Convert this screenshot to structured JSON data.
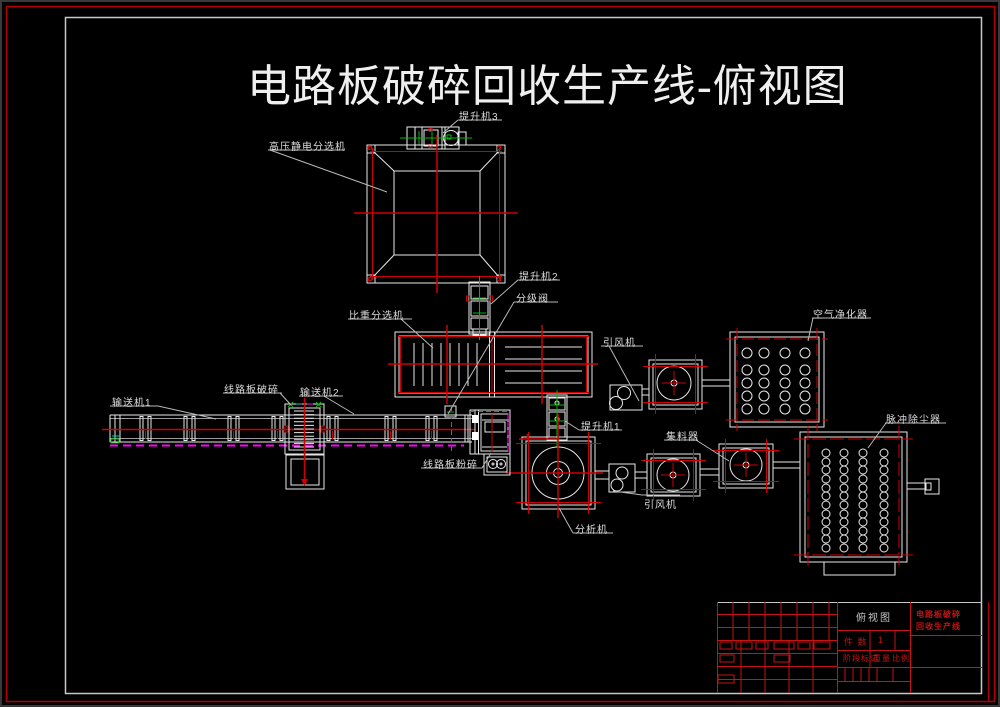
{
  "title": "电路板破碎回收生产线-俯视图",
  "labels": {
    "hoist3": "提升机3",
    "electrostatic_separator": "高压静电分选机",
    "hoist2": "提升机2",
    "classifier_valve": "分级阀",
    "gravity_separator": "比重分选机",
    "air_purifier": "空气净化器",
    "draft_fan_top": "引风机",
    "conveyor1": "输送机1",
    "pcb_crusher": "线路板破碎",
    "conveyor2": "输送机2",
    "collector": "集料器",
    "pulse_dust_collector": "脉冲除尘器",
    "hoist1": "提升机1",
    "pcb_pulverizer": "线路板粉碎",
    "analyzer": "分析机",
    "draft_fan_bottom": "引风机"
  },
  "title_block": {
    "view_name": "俯视图",
    "project_name_line1": "电路板破碎",
    "project_name_line2": "回收生产线",
    "quantity_label": "件 数",
    "quantity_value": "1",
    "stage_label": "阶段标记",
    "weight_label": "重量",
    "scale_label": "比例"
  },
  "colors": {
    "background": "#000000",
    "line_white": "#e8e8e8",
    "line_red": "#cf0000",
    "line_green": "#00b800",
    "line_magenta": "#ff00ff",
    "line_gray": "#b8b8b8",
    "frame_red": "#b40000",
    "frame_white": "#c8c8c8"
  }
}
